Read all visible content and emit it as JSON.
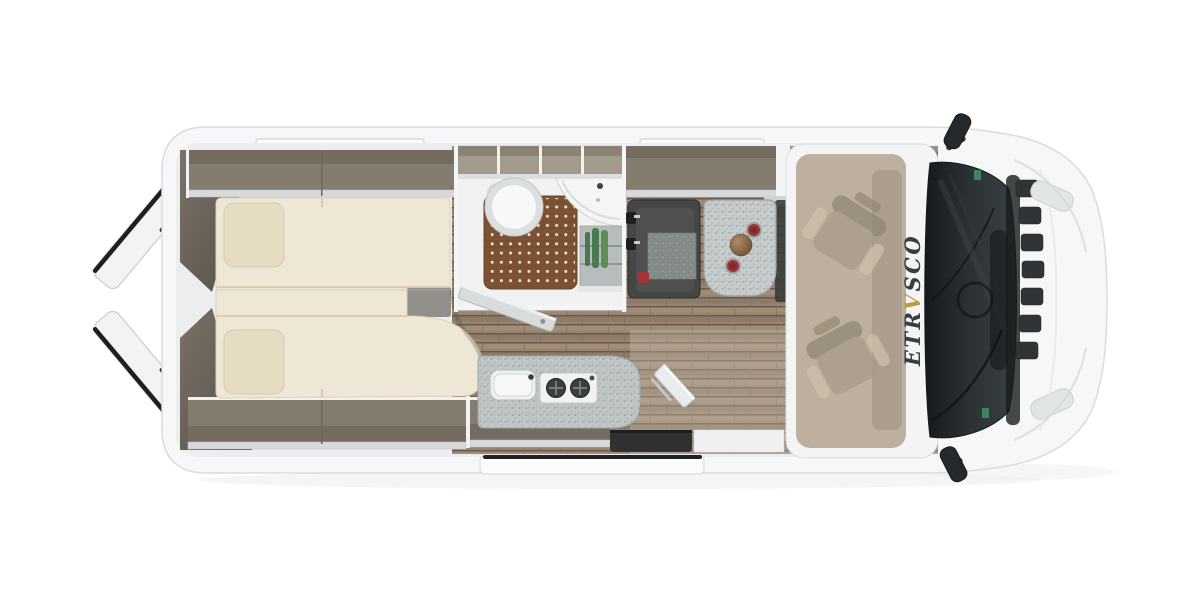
{
  "window": {
    "width": 1200,
    "height": 600,
    "background": "#ffffff"
  },
  "scene": {
    "type": "campervan-floorplan-top-view",
    "brand": {
      "text": "ETRVSCO",
      "parts": [
        "ETR",
        "V",
        "SCO"
      ],
      "accent_part": "V"
    },
    "objects": [
      {
        "name": "rear-door-open",
        "count": 2
      },
      {
        "name": "rear-window-strip",
        "count": 2
      },
      {
        "name": "single-bed-mattress",
        "count": 2
      },
      {
        "name": "pillow",
        "count": 2
      },
      {
        "name": "overhead-shelf",
        "count": 3
      },
      {
        "name": "overhead-locker-compartment",
        "count": 4
      },
      {
        "name": "toilet",
        "count": 1
      },
      {
        "name": "shower-duckboard",
        "count": 1
      },
      {
        "name": "corner-washbasin",
        "count": 1
      },
      {
        "name": "bathroom-shelf-bottle",
        "count": 3
      },
      {
        "name": "travel-bench-seat",
        "count": 1
      },
      {
        "name": "seatbelt-buckle",
        "count": 2
      },
      {
        "name": "dinette-table",
        "count": 1
      },
      {
        "name": "red-cup",
        "count": 2
      },
      {
        "name": "bronze-bowl",
        "count": 1
      },
      {
        "name": "kitchen-sink",
        "count": 1
      },
      {
        "name": "hob-burner",
        "count": 2
      },
      {
        "name": "worktop-extension-flap",
        "count": 1
      },
      {
        "name": "sliding-door-step",
        "count": 1
      },
      {
        "name": "entry-floor-mat",
        "count": 1
      },
      {
        "name": "swivel-cab-seat",
        "count": 2
      },
      {
        "name": "wing-mirror",
        "count": 2
      },
      {
        "name": "grille-slat",
        "count": 7
      },
      {
        "name": "headlight",
        "count": 2
      },
      {
        "name": "windshield",
        "count": 1
      }
    ]
  },
  "colors": {
    "body": "#f6f7f8",
    "body-outline": "#d9dcde",
    "wall": "#ecedee",
    "shelf": "#857c70",
    "shelf-shade": "#746c60",
    "lip": "#d7d9da",
    "mattress": "#efe7d6",
    "pillow": "#e6dcc4",
    "wood-dark": "#6b5a4b",
    "wood-mid": "#97836f",
    "duckboard": "#7d5233",
    "duckboard-dot": "#f4e8d6",
    "table-speckle": "#c6cbcb",
    "bench-dark": "#454746",
    "cushion": "#84898a",
    "cup-red": "#993333",
    "bowl-bronze": "#8a6a50",
    "bottle-green": "#4a7a52",
    "burner": "#3a3d3f",
    "poptop": "#bdb09f",
    "seat-beige": "#a79a88",
    "windshield": "#23272a",
    "mirror": "#26292b",
    "logo": "#3a3d3f",
    "accent": "#bf9b3f",
    "step-edge": "#202223"
  }
}
